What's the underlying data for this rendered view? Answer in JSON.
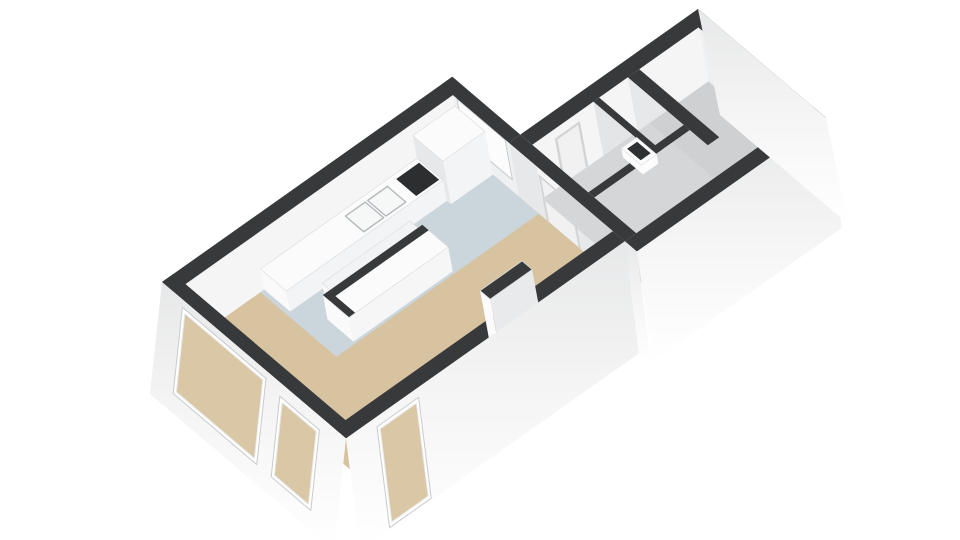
{
  "scene": {
    "description": "3D floor plan render of an apartment: living room, open kitchen with island, hallway with WC and entrance hall",
    "background": "#ffffff",
    "wall_height_m": 2.6,
    "colors": {
      "wall_top": "#38393b",
      "floor_living": "#d8c3a1",
      "floor_kitchen": "#cbd5dc",
      "floor_hall": "#d5d6d7",
      "floor_entrance": "#cfd0d2",
      "face_bright": "#f5f5f6",
      "face_mid": "#eef0f2",
      "face_dark": "#e6e8ea",
      "face_darker": "#e3e5e7",
      "window_glass": "#fcfcfd",
      "window_through": "#d9c7a5",
      "frame": "#c8cacc",
      "door_panel": "#f1f1f2",
      "door_frame": "#cfd1d3",
      "handle": "#9fa1a3",
      "counter_top": "#fbfbfc",
      "counter_face": "#f3f4f5",
      "counter_end": "#fafafb",
      "island_face": "#f6f6f7",
      "slab_top": "#f2f3f4",
      "cooktop": "#2d2e30",
      "sink_fill": "#f6f7f7",
      "sink_stroke": "#b5b8ba",
      "toilet": "#fdfdfe",
      "toilet_bowl": "#2f3032",
      "stub_face_py": "#e8eaec",
      "stub_face_mx": "#fbfbfc",
      "ext_top": "#e7e8e9",
      "ext_mid": "#f4f4f4",
      "ext_bottom": "#ffffff"
    },
    "rooms": [
      {
        "name": "living-room-floor",
        "rect": [
          0.3,
          0.3,
          7.3,
          4.3
        ],
        "color": "floor_living"
      },
      {
        "name": "kitchen-floor",
        "rect": [
          2.0,
          0.3,
          7.3,
          2.2
        ],
        "color": "floor_kitchen"
      },
      {
        "name": "hallway-floor",
        "rect": [
          7.6,
          2.0,
          11.95,
          4.6
        ],
        "color": "floor_hall"
      },
      {
        "name": "entrance-hall-floor",
        "rect": [
          10.4,
          2.0,
          11.95,
          4.6
        ],
        "color": "floor_entrance"
      }
    ],
    "interior_faces": [
      {
        "name": "wall-face-living-nw",
        "kind": "u",
        "at": 0.3,
        "from": 0.3,
        "to": 7.3,
        "color": "face_bright"
      },
      {
        "name": "wall-face-kitchen-jog",
        "kind": "v",
        "at": 7.3,
        "from": 0.3,
        "to": 1.7,
        "color": "face_mid"
      },
      {
        "name": "wall-face-living-ne",
        "kind": "v",
        "at": 7.3,
        "from": 1.7,
        "to": 4.3,
        "color": "face_dark"
      },
      {
        "name": "wall-face-hall-nw",
        "kind": "u",
        "at": 2.0,
        "from": 7.6,
        "to": 11.95,
        "color": "face_bright"
      },
      {
        "name": "wall-face-ne-end",
        "kind": "v",
        "at": 11.95,
        "from": 2.0,
        "to": 4.6,
        "color": "face_mid"
      },
      {
        "name": "wall-face-entrance-sw",
        "kind": "v",
        "at": 10.1,
        "from": 2.0,
        "to": 4.0,
        "color": "face_dark"
      },
      {
        "name": "wall-face-wc-sw",
        "kind": "v",
        "at": 9.2,
        "from": 2.0,
        "to": 3.4,
        "color": "face_darker"
      },
      {
        "name": "wall-face-wc-se",
        "kind": "u",
        "at": 3.55,
        "from": 9.35,
        "to": 10.1,
        "color": "face_bright"
      },
      {
        "name": "wall-face-leftroom-se",
        "kind": "u",
        "at": 3.55,
        "from": 7.6,
        "to": 8.85,
        "color": "face_bright"
      }
    ],
    "interior_windows": [
      {
        "name": "window-kitchen-jog",
        "face": "wall-face-kitchen-jog",
        "span": [
          0.45,
          1.55
        ],
        "height": [
          0.28,
          0.96
        ]
      }
    ],
    "doors": [
      {
        "name": "door-kitchen-hall",
        "face": "wall-face-living-ne",
        "span": [
          2.45,
          3.2
        ],
        "height": [
          0.0,
          0.82
        ],
        "handle": false
      },
      {
        "name": "door-hall-closet",
        "face": "wall-face-hall-nw",
        "span": [
          8.2,
          8.75
        ],
        "height": [
          0.0,
          0.8
        ],
        "handle": false
      },
      {
        "name": "door-front",
        "face": "wall-face-ne-end",
        "span": [
          2.85,
          3.55
        ],
        "height": [
          0.0,
          0.85
        ],
        "handle": true
      },
      {
        "name": "door-wc",
        "face": "wall-face-wc-se",
        "span": [
          9.42,
          9.95
        ],
        "height": [
          0.0,
          0.8
        ],
        "handle": false
      }
    ],
    "wall_bands": [
      {
        "name": "wall-top-living-nw",
        "rect": [
          0.0,
          0.0,
          7.6,
          0.3
        ]
      },
      {
        "name": "wall-top-jog-window",
        "rect": [
          7.3,
          0.0,
          7.6,
          1.7
        ]
      },
      {
        "name": "wall-top-hall-nw",
        "rect": [
          7.6,
          1.7,
          12.25,
          2.0
        ]
      },
      {
        "name": "wall-top-ne-end",
        "rect": [
          11.95,
          1.7,
          12.25,
          4.9
        ]
      },
      {
        "name": "wall-top-hall-se",
        "rect": [
          7.3,
          4.6,
          12.25,
          4.9
        ]
      },
      {
        "name": "wall-top-living-se",
        "rect": [
          0.0,
          4.3,
          7.3,
          4.6
        ]
      },
      {
        "name": "wall-top-sw-end",
        "rect": [
          0.0,
          0.0,
          0.3,
          4.6
        ]
      },
      {
        "name": "wall-top-living-ne",
        "rect": [
          7.3,
          1.7,
          7.6,
          4.6
        ]
      },
      {
        "name": "wall-top-entrance",
        "rect": [
          10.1,
          2.0,
          10.4,
          4.0
        ]
      },
      {
        "name": "wall-top-wc-sw",
        "rect": [
          9.2,
          2.0,
          9.35,
          3.55
        ]
      },
      {
        "name": "wall-top-wc-se",
        "rect": [
          9.2,
          3.4,
          10.1,
          3.55
        ]
      },
      {
        "name": "wall-top-leftroom-se",
        "rect": [
          7.6,
          3.4,
          8.85,
          3.55
        ]
      }
    ],
    "boxes": [
      {
        "name": "kitchen-tall-cabinet",
        "rect": [
          6.2,
          0.3,
          7.3,
          1.05
        ],
        "h": 0.8,
        "face_py": "counter_face",
        "face_mx": "face_dark",
        "top": "counter_top",
        "insets": []
      },
      {
        "name": "kitchen-counter",
        "rect": [
          2.1,
          0.3,
          6.2,
          0.95
        ],
        "h": 0.38,
        "face_py": "counter_face",
        "face_mx": "counter_end",
        "top": "counter_top",
        "insets": [
          {
            "name": "sink-basin-left",
            "rect": [
              4.2,
              0.42,
              4.72,
              0.88
            ],
            "fill": "sink_fill",
            "stroke": "sink_stroke"
          },
          {
            "name": "sink-basin-right",
            "rect": [
              4.78,
              0.42,
              5.3,
              0.88
            ],
            "fill": "sink_fill",
            "stroke": "sink_stroke"
          },
          {
            "name": "cooktop",
            "rect": [
              5.55,
              0.4,
              6.15,
              0.9
            ],
            "fill": "cooktop",
            "stroke": ""
          }
        ]
      },
      {
        "name": "kitchen-counter-slab",
        "rect": [
          2.8,
          1.15,
          5.1,
          1.5
        ],
        "h": 0.3,
        "face_py": "counter_face",
        "face_mx": "counter_end",
        "top": "slab_top",
        "insets": []
      },
      {
        "name": "kitchen-island",
        "rect": [
          2.5,
          1.5,
          5.1,
          2.15
        ],
        "h": 0.45,
        "face_py": "island_face",
        "face_mx": "counter_end",
        "top": "counter_top",
        "insets": [
          {
            "name": "island-bar-edge",
            "rect": [
              2.5,
              1.5,
              5.1,
              1.66
            ],
            "fill": "wall_top",
            "stroke": ""
          },
          {
            "name": "island-end-edge",
            "rect": [
              2.5,
              1.5,
              2.66,
              2.15
            ],
            "fill": "wall_top",
            "stroke": ""
          }
        ]
      },
      {
        "name": "toilet",
        "rect": [
          9.45,
          2.25,
          9.85,
          2.75
        ],
        "h": 0.17,
        "face_py": "toilet",
        "face_mx": "toilet",
        "top": "toilet",
        "insets": [
          {
            "name": "toilet-bowl",
            "rect": [
              9.52,
              2.33,
              9.78,
              2.67
            ],
            "fill": "toilet_bowl",
            "stroke": ""
          }
        ]
      },
      {
        "name": "stub-wall",
        "rect": [
          4.4,
          3.75,
          5.5,
          4.0
        ],
        "h": 1.0,
        "face_py": "stub_face_py",
        "face_mx": "stub_face_mx",
        "top": "wall_top",
        "insets": []
      }
    ],
    "exterior_faces": [
      {
        "name": "exterior-sw-end",
        "kind": "v",
        "at": 0.0,
        "from": 0.0,
        "to": 4.6,
        "drop": [
          -12,
          112
        ]
      },
      {
        "name": "exterior-living-se",
        "kind": "u",
        "at": 4.6,
        "from": 0.0,
        "to": 7.3,
        "drop": [
          14,
          112
        ]
      },
      {
        "name": "exterior-jog-se",
        "kind": "v",
        "at": 7.3,
        "from": 4.6,
        "to": 4.9,
        "drop": [
          14,
          112
        ]
      },
      {
        "name": "exterior-hall-se",
        "kind": "u",
        "at": 4.9,
        "from": 7.3,
        "to": 12.25,
        "drop": [
          16,
          110
        ]
      },
      {
        "name": "exterior-ne-end",
        "kind": "v",
        "at": 12.25,
        "from": 1.7,
        "to": 4.9,
        "drop": [
          22,
          106
        ]
      }
    ],
    "exterior_windows": [
      {
        "name": "window-sw-large",
        "face": "exterior-sw-end",
        "span": [
          0.6,
          2.55
        ],
        "s": [
          0.1,
          0.8
        ]
      },
      {
        "name": "window-sw-small",
        "face": "exterior-sw-end",
        "span": [
          3.05,
          3.9
        ],
        "s": [
          0.15,
          0.8
        ]
      },
      {
        "name": "window-se-living",
        "face": "exterior-living-se",
        "span": [
          0.85,
          1.8
        ],
        "s": [
          0.12,
          0.95
        ]
      }
    ]
  }
}
